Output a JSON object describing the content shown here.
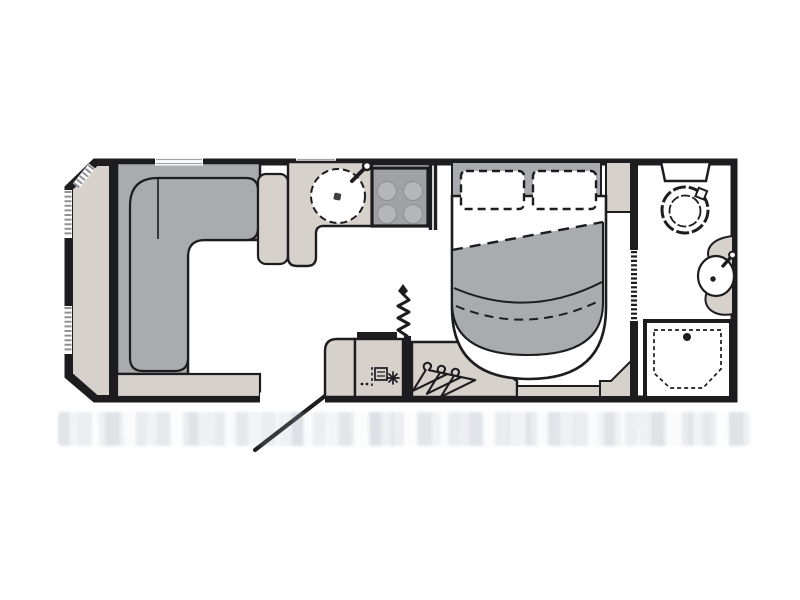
{
  "floorplan": {
    "type": "caravan-floorplan",
    "zones": [
      {
        "name": "lounge",
        "fixtures": [
          "front-chest",
          "l-shaped-sofa",
          "sofa-end-table",
          "side-step"
        ]
      },
      {
        "name": "kitchen",
        "fixtures": [
          "worktop",
          "round-sink",
          "tap",
          "hob-4-burner"
        ]
      },
      {
        "name": "utility",
        "fixtures": [
          "entry-door",
          "base-unit",
          "fridge",
          "flue-coil",
          "wardrobe-hangers"
        ]
      },
      {
        "name": "bedroom",
        "fixtures": [
          "bedhead",
          "pillow-left",
          "pillow-right",
          "island-bed",
          "duvet",
          "bedside-shelf",
          "corner-step"
        ]
      },
      {
        "name": "bathroom",
        "fixtures": [
          "concertina-door",
          "toilet",
          "vanity-counter",
          "basin",
          "tap",
          "shower-tray"
        ]
      }
    ],
    "window_count": {
      "front_wall": 3,
      "top_wall": 2
    },
    "hanger_count": 3,
    "hob_burner_count": 4
  },
  "colors": {
    "paper": "#ffffff",
    "wall": "#1d1d20",
    "floor": "#ffffff",
    "upholstery": "#a9abae",
    "worktop": "#d7d1cb",
    "appliance": "#a0a2a6",
    "burner": "#b4b6b9",
    "hatch": "#8f9195",
    "windowline": "#a2a4a8",
    "noise": "#ccd1d8"
  }
}
